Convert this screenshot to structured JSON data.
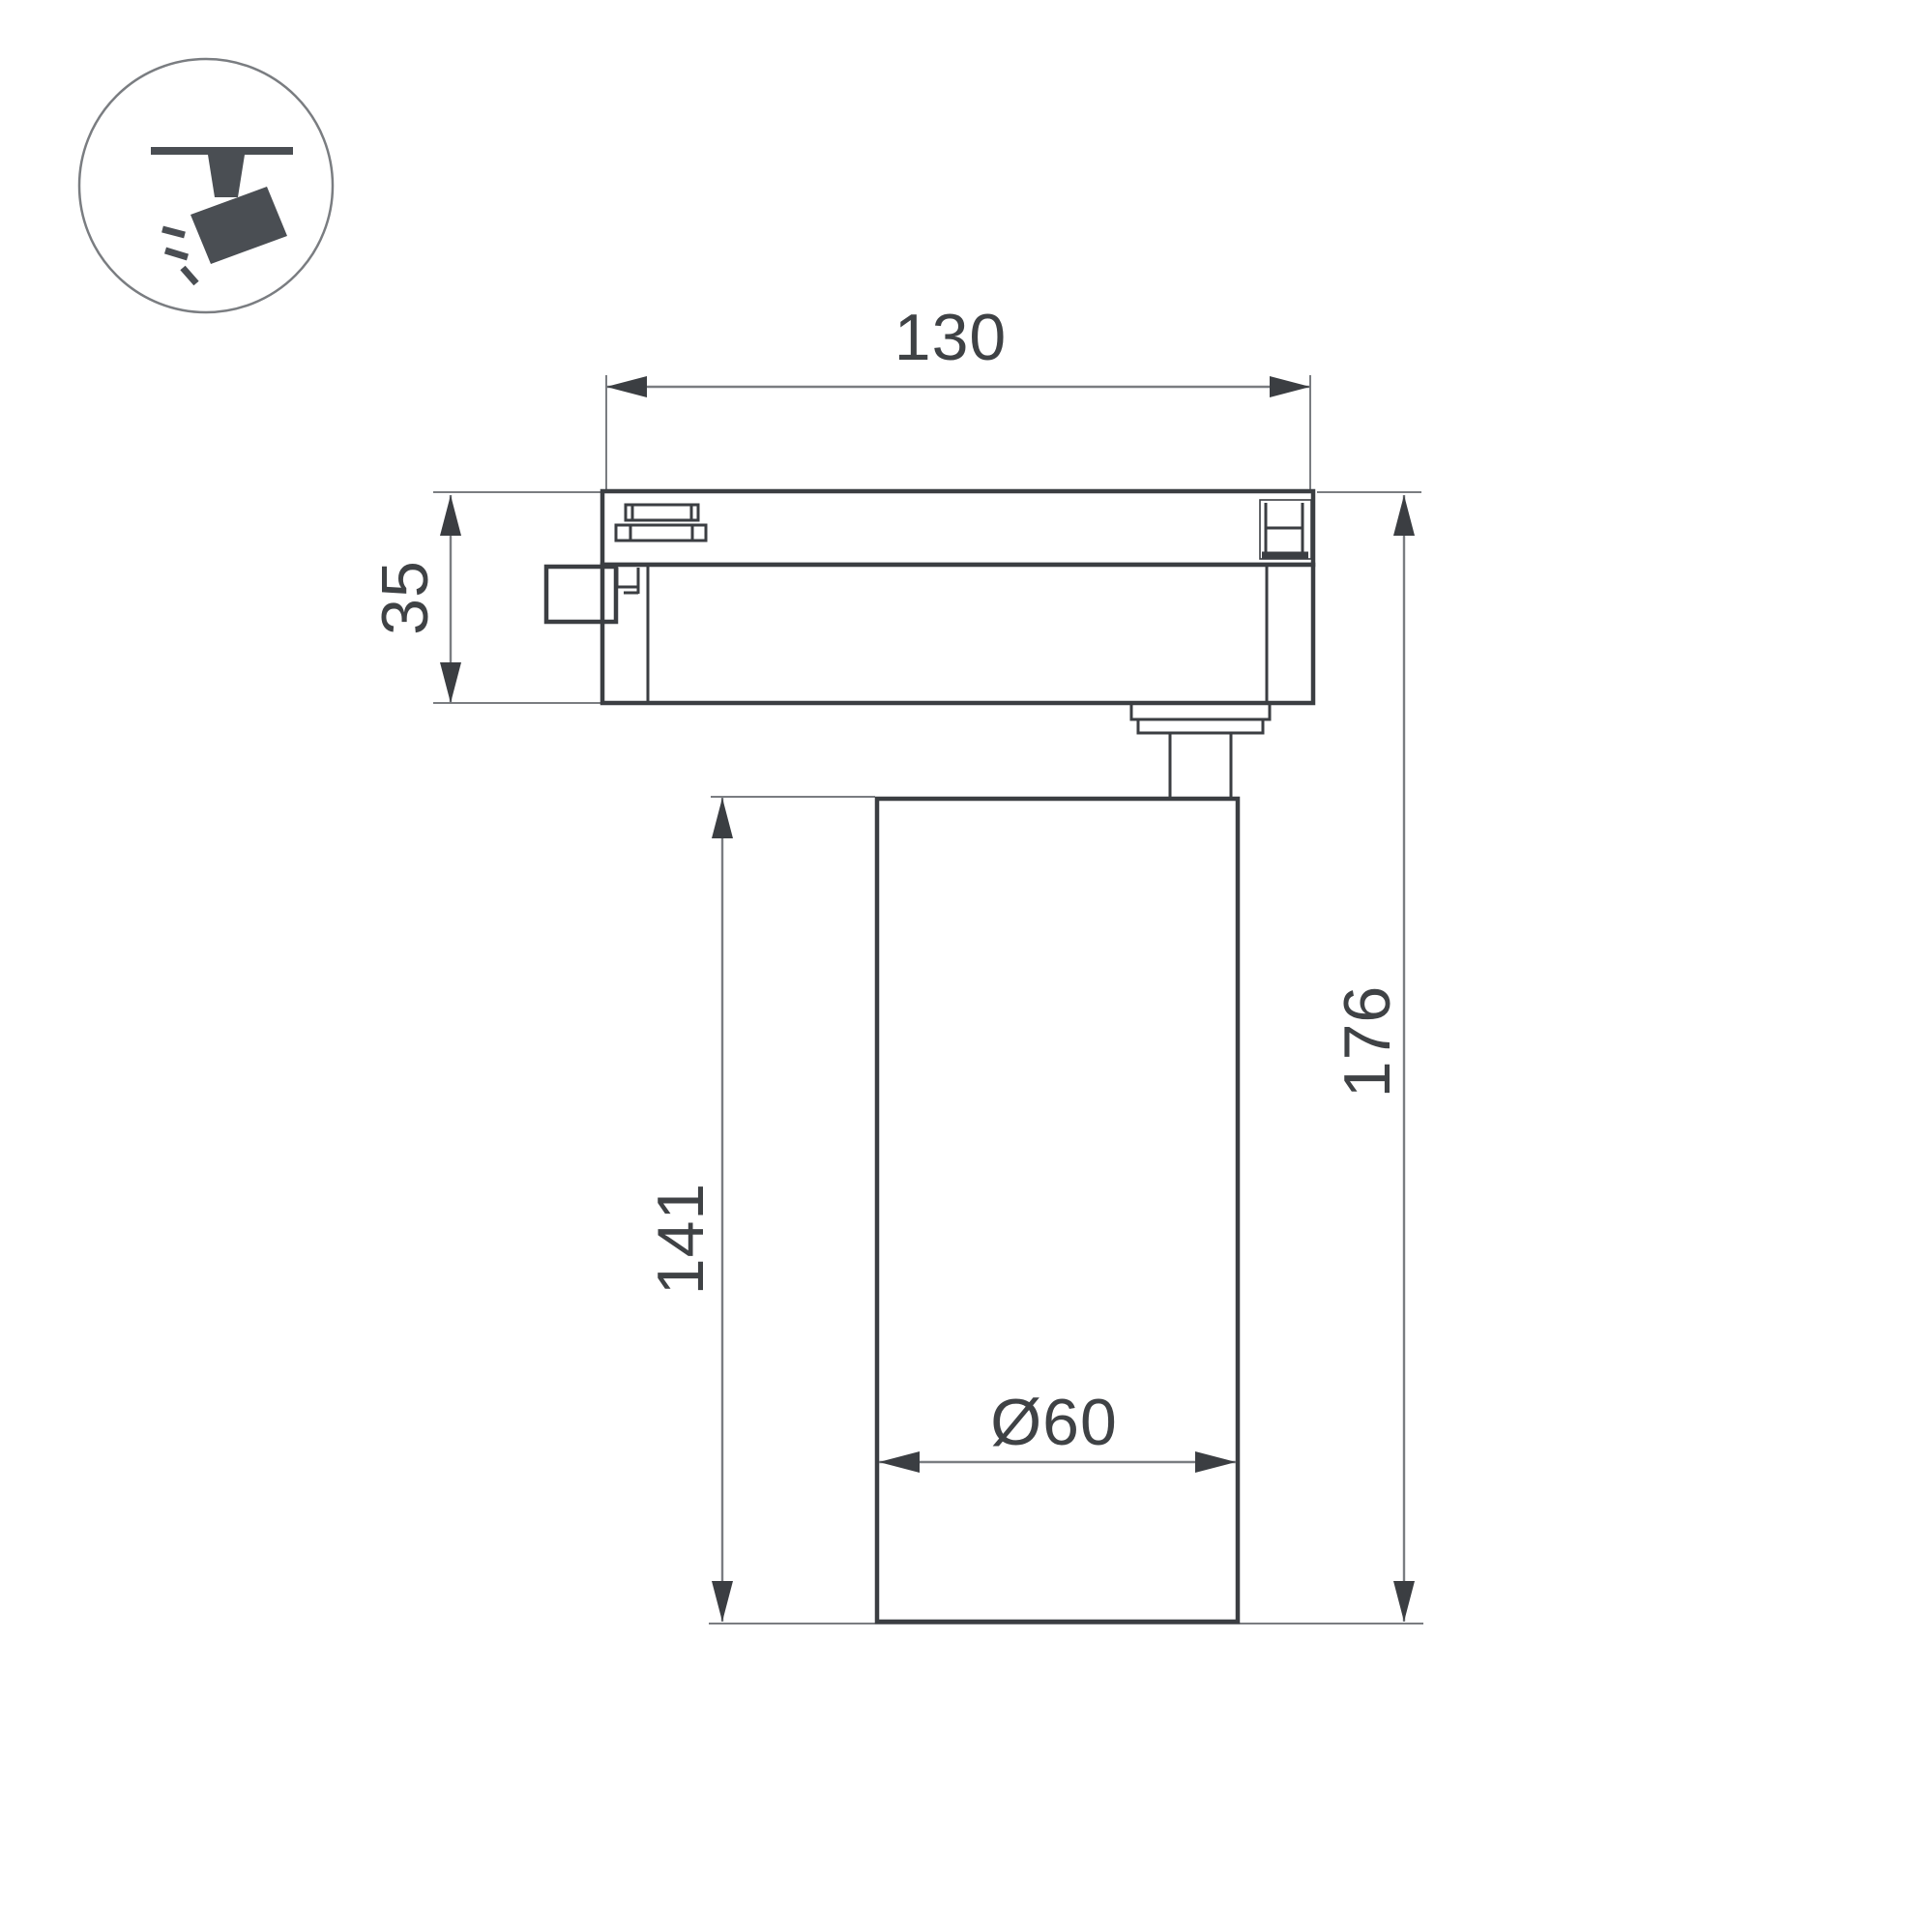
{
  "page": {
    "kind": "technical dimension drawing",
    "subject": "LED track spotlight side view"
  },
  "icon": {
    "name": "track-spotlight-icon"
  },
  "dimensions": {
    "track_width": "130",
    "adapter_height": "35",
    "lamp_body_height": "141",
    "total_height": "176",
    "body_diameter": "Ø60"
  },
  "colors": {
    "line_dark": "#3b3e42",
    "line_thin": "#7a7d81",
    "text": "#3f4245",
    "icon": "#4a4e53",
    "background": "#ffffff"
  }
}
